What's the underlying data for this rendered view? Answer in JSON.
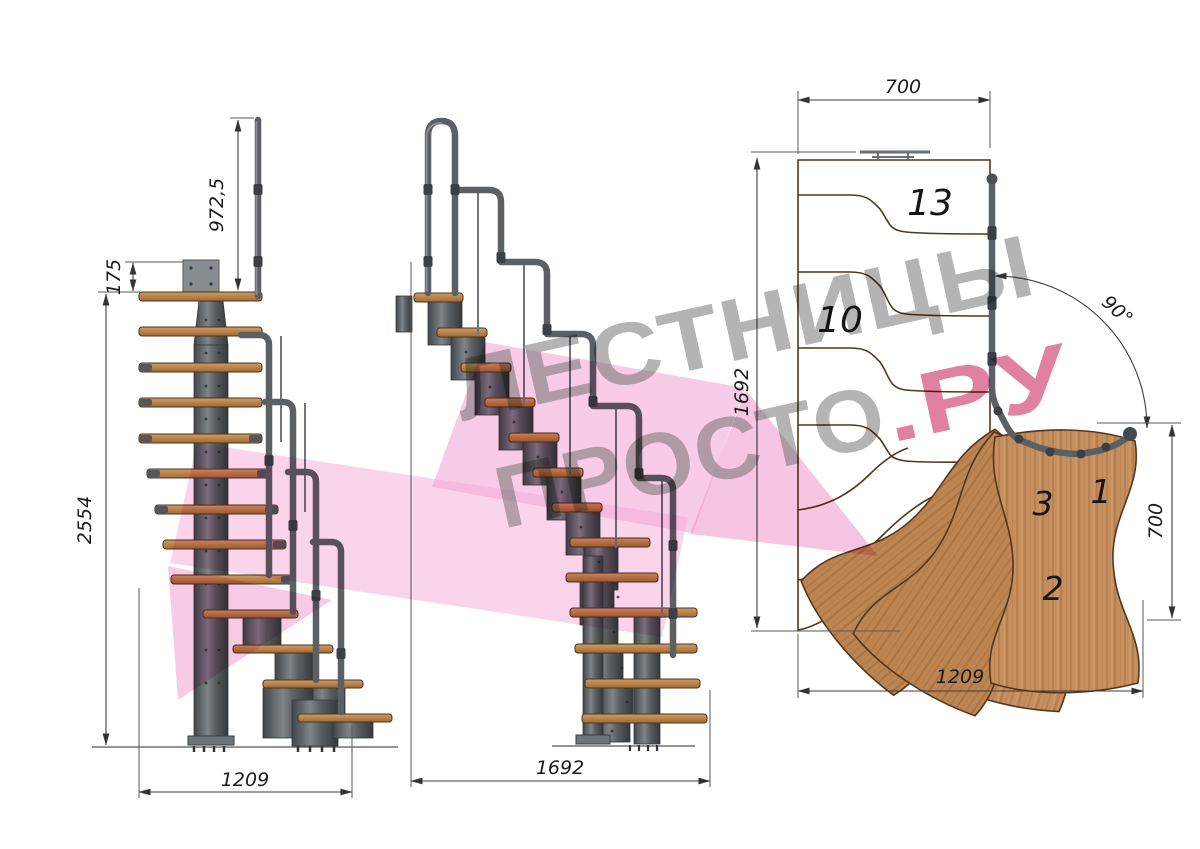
{
  "watermark": {
    "line1": "ЛЕСТНИЦЫ",
    "line2_main": "ПРОСТО",
    "line2_accent": ".РУ",
    "gray_color": "#696969",
    "accent_color": "#c9265e"
  },
  "views": {
    "front_elevation": {
      "dimensions": {
        "handrail_height": "972,5",
        "plate_offset": "175",
        "total_height": "2554",
        "base_width": "1209"
      }
    },
    "side_elevation": {
      "dimensions": {
        "total_run": "1692"
      }
    },
    "plan_view": {
      "dimensions": {
        "upper_flight_width": "700",
        "upper_flight_run": "1692",
        "turn_angle": "90°",
        "lower_flight_width": "700",
        "lower_flight_run": "1209"
      },
      "step_numbers": {
        "platform": "13",
        "upper": "10",
        "winder": "3",
        "entry": "1",
        "second": "2"
      }
    }
  },
  "colors": {
    "wood": "#c68f5e",
    "steel": "#5a6064",
    "dimension_lines": "#3d3d3d",
    "background": "#ffffff"
  }
}
